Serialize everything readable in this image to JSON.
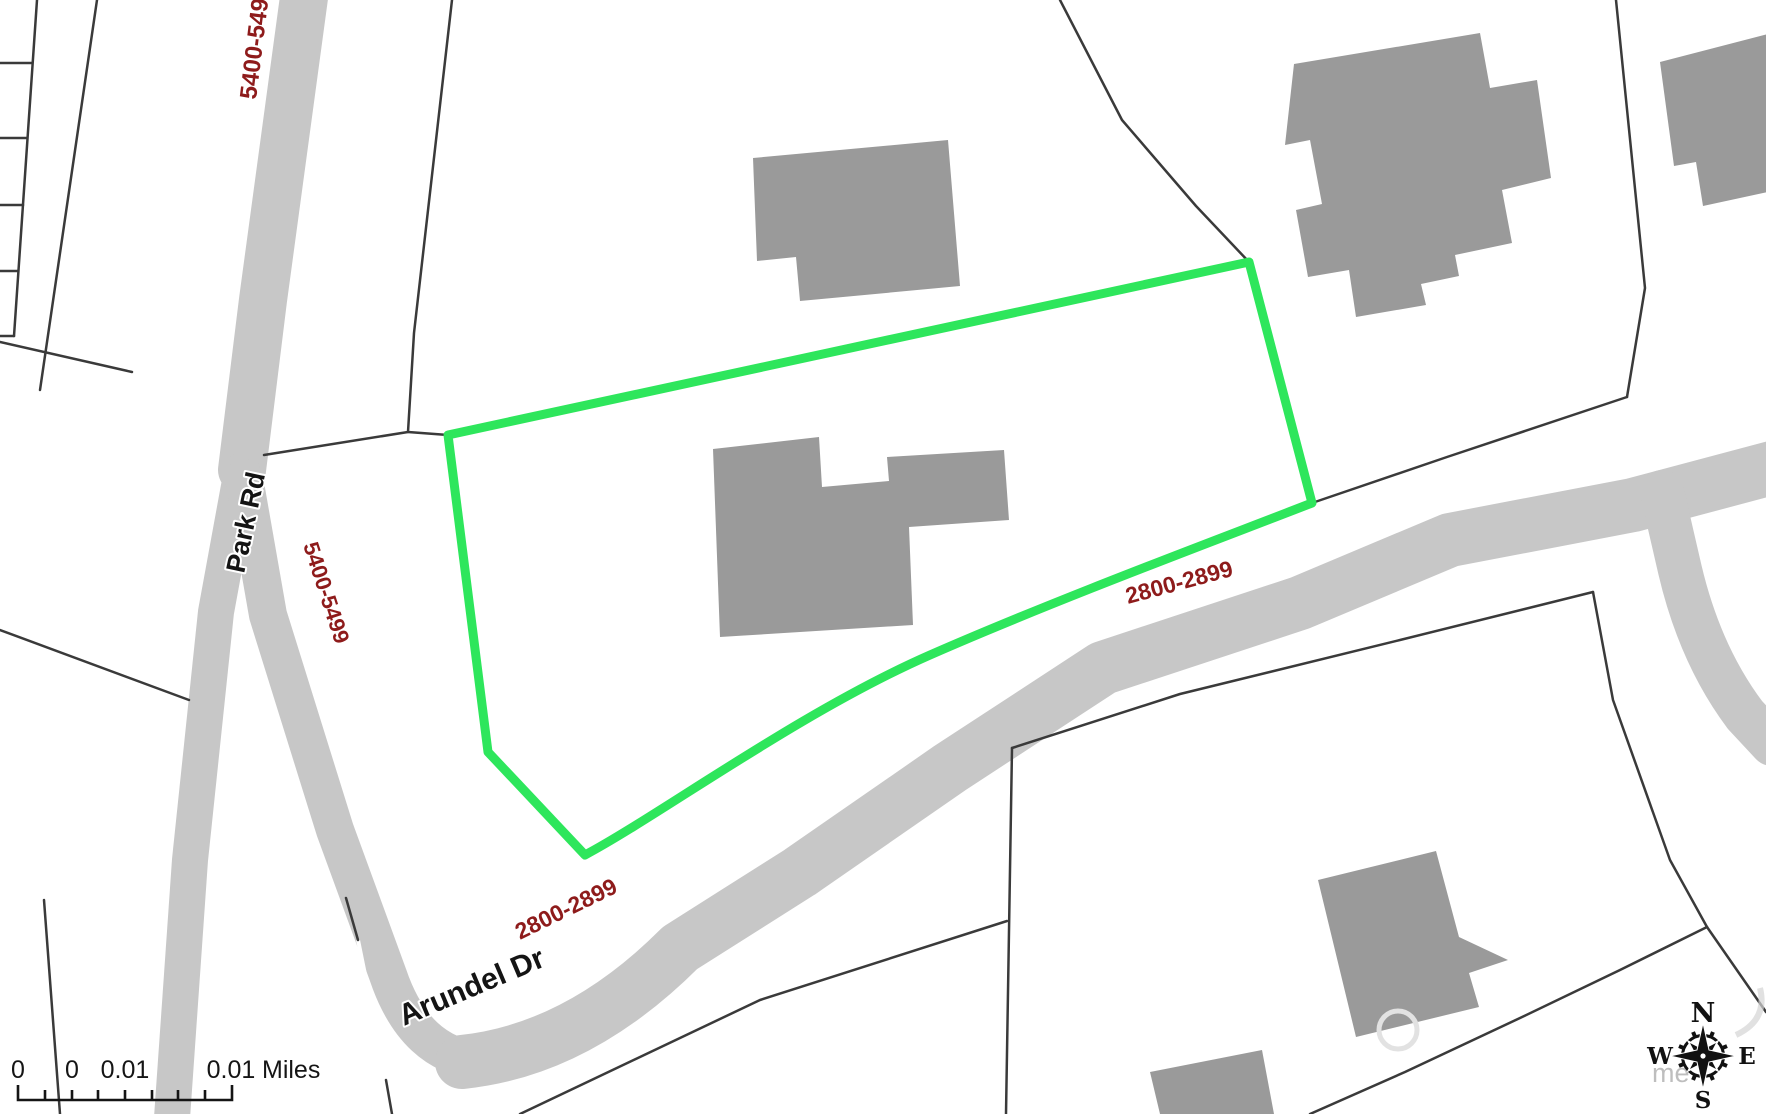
{
  "map": {
    "road_labels": [
      {
        "name": "park-rd",
        "text": "Park Rd"
      },
      {
        "name": "arundel-dr",
        "text": "Arundel Dr"
      }
    ],
    "address_range_labels": [
      {
        "name": "park-rd-upper-range",
        "text": "5400-5499"
      },
      {
        "name": "park-rd-lower-range",
        "text": "5400-5499"
      },
      {
        "name": "arundel-upper-range",
        "text": "2800-2899"
      },
      {
        "name": "arundel-lower-range",
        "text": "2800-2899"
      }
    ],
    "colors": {
      "road": "#c7c7c7",
      "building": "#9a9a9a",
      "parcel_line": "#3a3a3a",
      "selected_parcel_outline": "#2ee65c",
      "address_label": "#8e1b1b",
      "street_label": "#141414"
    }
  },
  "scalebar": {
    "tick_labels": [
      "0",
      "0",
      "0.01",
      "0.01"
    ],
    "unit_label": "Miles"
  },
  "compass": {
    "n": "N",
    "e": "E",
    "s": "S",
    "w": "W"
  },
  "watermark": {
    "partial_text": "me"
  }
}
